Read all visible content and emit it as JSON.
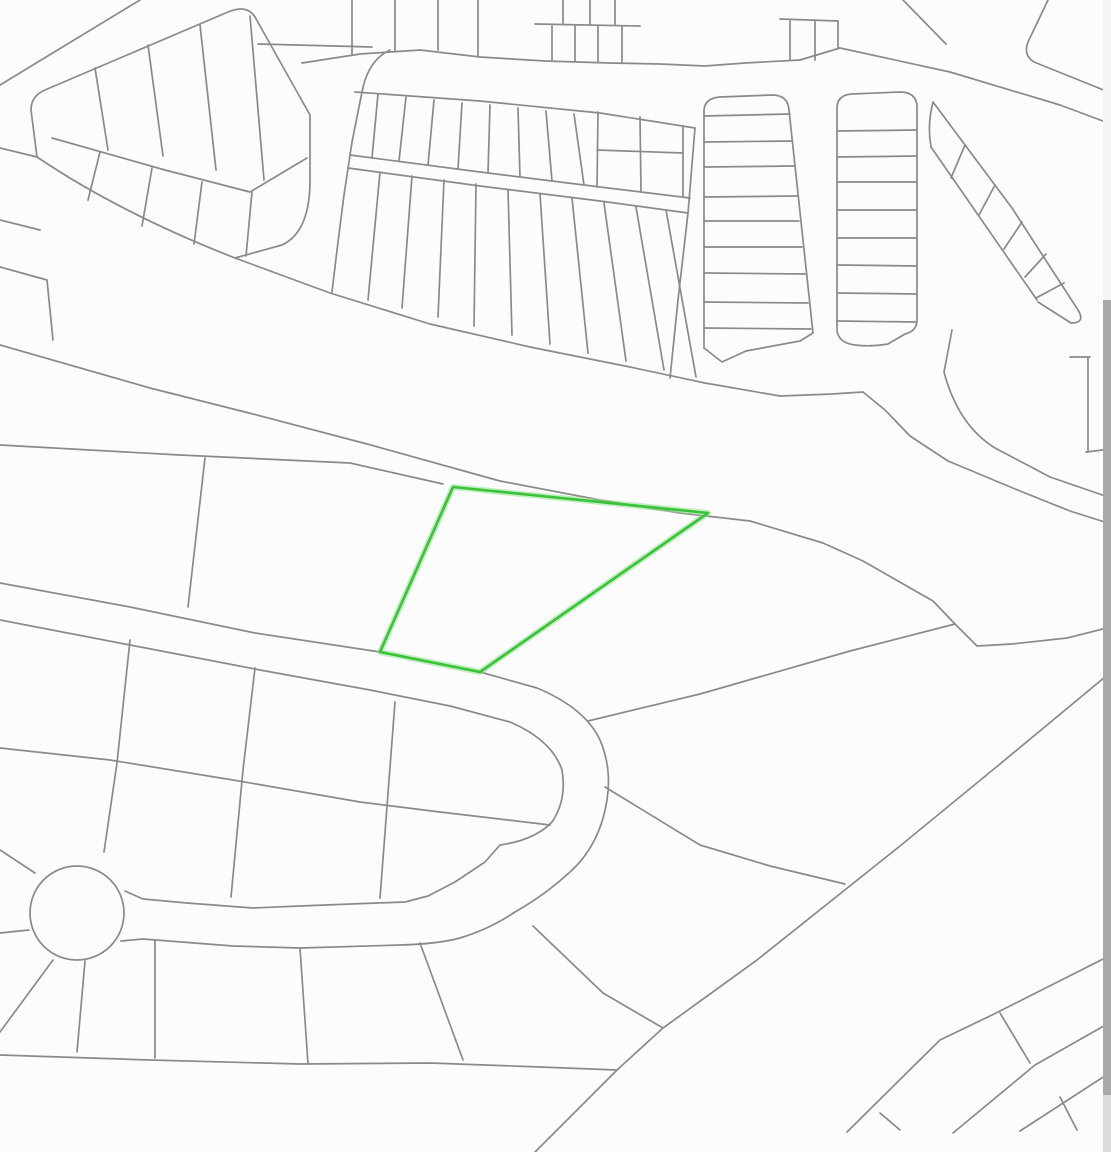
{
  "canvas": {
    "width": 1111,
    "height": 1152,
    "background": "#fcfcfc"
  },
  "map": {
    "kind": "parcel-plat-map",
    "line_color": "#8a8a8a",
    "line_width": 1.7,
    "highlight_parcel": {
      "outline_color": "#38c338",
      "halo_color": "#8fe08f",
      "outline_width": 2.6,
      "halo_width": 6,
      "path": "M453,487 L708,513 L480,672 L380,652 Z"
    },
    "paths": [
      {
        "n": "nw-diagonal-road-line",
        "d": "M0,85 L140,0"
      },
      {
        "n": "topleft-block-outline",
        "d": "M37,157 L31,110 Q31,96 45,90 L228,12 Q247,4 255,17 L310,115 L310,180 Q310,232 282,245 L235,258"
      },
      {
        "n": "topleft-block-midline",
        "d": "M52,138 L165,170 L250,192 L307,158"
      },
      {
        "n": "topleft-block-dividers",
        "d": "M95,68 L108,150 M148,45 L163,156 M200,25 L216,170 M250,16 L264,180 M100,152 L88,200 M152,168 L142,226 M202,182 L194,244 M252,192 L246,256"
      },
      {
        "n": "left-edge-stub-line",
        "d": "M0,220 L40,230"
      },
      {
        "n": "road-crossing-line",
        "d": "M258,44 L372,47"
      },
      {
        "n": "top-road-upper-edge",
        "d": "M302,63 L360,54 L420,50 L480,57 L545,61 L610,63 L660,64 L705,66 L745,63 L800,60 L840,48"
      },
      {
        "n": "top-edge-lot-stubs",
        "d": "M352,0 L352,55 M395,0 L395,51 M438,0 L438,50 M478,0 L478,56"
      },
      {
        "n": "top-miniblock-lots",
        "d": "M535,24 L640,26 M563,0 L563,24 M590,0 L590,25 M615,0 L615,25 M552,26 L552,60 M575,26 L575,61 M598,26 L598,62 M622,26 L622,62"
      },
      {
        "n": "topright-miniblock-lots",
        "d": "M780,19 L838,21 M790,21 L790,60 M815,20 L815,60 M838,21 L838,48"
      },
      {
        "n": "central-block-left-edge",
        "d": "M390,50 Q368,60 362,92 L352,142 L344,195 L337,250 L332,292"
      },
      {
        "n": "top-road-lower-edge",
        "d": "M355,92 L480,101 L600,113 L695,128"
      },
      {
        "n": "upper-band-bottom-edge",
        "d": "M350,155 L480,172 L600,187 L690,198"
      },
      {
        "n": "upper-band-lot-dividers",
        "d": "M378,94 L372,158 M406,97 L399,161 M434,100 L428,165 M462,103 L458,169 M490,105 L488,173 M518,108 L520,177 M546,111 L552,181 M574,114 L584,185"
      },
      {
        "n": "upper-band-east-lots",
        "d": "M598,112 L597,187 M640,117 L641,192 M683,126 L683,197 M597,150 L683,153"
      },
      {
        "n": "mid-road-lower-edge",
        "d": "M348,168 L480,186 L600,201 L688,213"
      },
      {
        "n": "lower-band-lot-dividers",
        "d": "M380,172 L368,300 M412,176 L402,308 M444,180 L438,317 M476,184 L474,326 M508,190 L512,335 M540,194 L550,344 M572,198 L588,353 M604,203 L626,361 M636,207 L664,370 M666,210 L696,377"
      },
      {
        "n": "vertical-road-west-edge",
        "d": "M695,128 L688,213 L678,300 L670,378"
      },
      {
        "n": "ladder-strip1-outline",
        "d": "M704,348 L704,110 Q705,98 720,97 L772,95 Q788,95 789,110 L813,333 M704,348 L722,362 L746,351 L800,341 L813,333"
      },
      {
        "n": "ladder-strip1-rungs",
        "d": "M704,116 L790,114 M704,142 L792,141 M704,167 L794,166 M704,197 L797,196 M704,221 L799,221 M704,247 L802,247 M704,273 L805,274 M704,302 L808,303 M704,328 L811,329"
      },
      {
        "n": "ladder-strip2-outline",
        "d": "M837,331 L837,108 Q837,95 852,94 L900,92 Q916,92 917,106 L917,320 Q917,331 905,334 L888,344 Q870,347 855,345 Q839,343 837,331"
      },
      {
        "n": "ladder-strip2-rungs",
        "d": "M837,131 L917,130 M837,157 L917,156 M837,182 L917,182 M837,210 L917,210 M837,238 L917,238 M837,265 L917,266 M837,293 L917,294 M837,321 L916,322"
      },
      {
        "n": "ne-lot-strip-outline",
        "d": "M933,102 Q927,125 931,147 L1037,300 M933,102 L1012,208 L1078,310 Q1086,323 1071,323 L1038,302"
      },
      {
        "n": "ne-lot-strip-rungs",
        "d": "M965,145 L951,178 M995,185 L979,215 M1022,222 L1004,249 M1046,254 L1025,277 M1064,283 L1036,298"
      },
      {
        "n": "ne-road-lower-edge",
        "d": "M840,48 L950,72 L1060,105 L1111,124"
      },
      {
        "n": "ne-road-top-stub",
        "d": "M903,0 L946,44"
      },
      {
        "n": "ne-road-upper-edge",
        "d": "M1048,0 L1028,42 Q1023,55 1034,62 L1111,93"
      },
      {
        "n": "east-road-curve",
        "d": "M952,330 L944,372 Q958,425 995,448 L1050,477 L1111,498"
      },
      {
        "n": "east-edge-parcel-lines",
        "d": "M1070,357 L1090,357 M1088,357 L1088,452 M1086,452 L1111,449"
      },
      {
        "n": "main-road-north-edge",
        "d": "M0,148 L37,157 Q120,213 235,258 L330,293 L430,324 L530,347 L630,367 L705,383 L780,396 L832,394 L863,392 L885,410 L910,436 L948,461 L1020,491 L1070,511 L1111,524"
      },
      {
        "n": "main-road-south-edge",
        "d": "M0,345 L150,388 L253,414 L367,444 L500,481 L600,500 L680,513 L750,521 L823,543 L863,561 L933,601 L955,624 L977,646 L1012,644 L1067,638 L1111,627"
      },
      {
        "n": "road-island-wedge",
        "d": "M0,267 L47,280 L53,340"
      },
      {
        "n": "parcel-row-north-line",
        "d": "M0,445 L180,455 L350,463 L443,484"
      },
      {
        "n": "parcel-row-divider",
        "d": "M205,458 L188,607"
      },
      {
        "n": "parcel-boundary-east",
        "d": "M588,721 L700,694 L850,651 L955,624"
      },
      {
        "n": "loop-road-outer-edge",
        "d": "M0,583 L130,607 L255,633 L380,652 L480,672 L537,688 Q585,708 600,740 Q612,768 607,800 Q600,845 570,872 Q545,895 515,912 Q490,929 460,938 Q438,944 400,945 L300,948 L233,946 L143,939 L121,941"
      },
      {
        "n": "loop-road-inner-edge",
        "d": "M0,620 L130,645 L260,670 L370,690 L450,706 L510,722 Q552,740 562,770 Q567,800 552,822 Q535,840 500,845 L485,862 L455,882 L428,896 L405,902 L377,903 L300,906 L253,908 L187,903 L143,899 L125,891"
      },
      {
        "n": "culdesac-bulb",
        "d": "M124,913 a47,47 0 1 0 -94,0 a47,47 0 1 0 94,0"
      },
      {
        "n": "island-lot-dividers",
        "d": "M130,640 L117,763 L104,852 M255,668 L243,770 L231,897 M395,702 L380,898"
      },
      {
        "n": "island-mid-line",
        "d": "M0,748 L110,760 L233,780 L360,802 L440,812 L550,825"
      },
      {
        "n": "west-parcel-lines",
        "d": "M0,850 L35,873 M0,933 L29,930"
      },
      {
        "n": "south-fan-dividers",
        "d": "M53,960 L0,1032 M85,961 L77,1052 M155,941 L155,1058 M300,948 L308,1064 M420,943 L463,1060"
      },
      {
        "n": "south-boundary-line",
        "d": "M0,1055 L150,1060 L300,1064 L430,1063 L540,1067 L617,1070"
      },
      {
        "n": "se-divider",
        "d": "M533,926 L603,993 L663,1028"
      },
      {
        "n": "long-diagonal-boundary",
        "d": "M535,1152 L617,1070 L663,1028 L757,960 L900,846 L1000,764 L1111,672"
      },
      {
        "n": "mid-south-boundary",
        "d": "M605,787 L700,845 L770,866 L845,884"
      },
      {
        "n": "se-corner-band",
        "d": "M847,1132 L940,1040 L992,1015 L1111,955 M953,1133 L1035,1065 L1102,1027 L1111,1022 M1020,1131 L1111,1072"
      },
      {
        "n": "se-corner-rungs",
        "d": "M1000,1013 L1030,1063 M880,1113 L900,1130 M1060,1097 L1077,1130"
      }
    ]
  },
  "scrollbar": {
    "width": 8,
    "track_color": "#f5f5f5",
    "thumb_color": "#a9a9a9",
    "thumb_top": 300,
    "thumb_height": 795,
    "lower_color": "#dcdcdc",
    "lower_height": 57
  }
}
